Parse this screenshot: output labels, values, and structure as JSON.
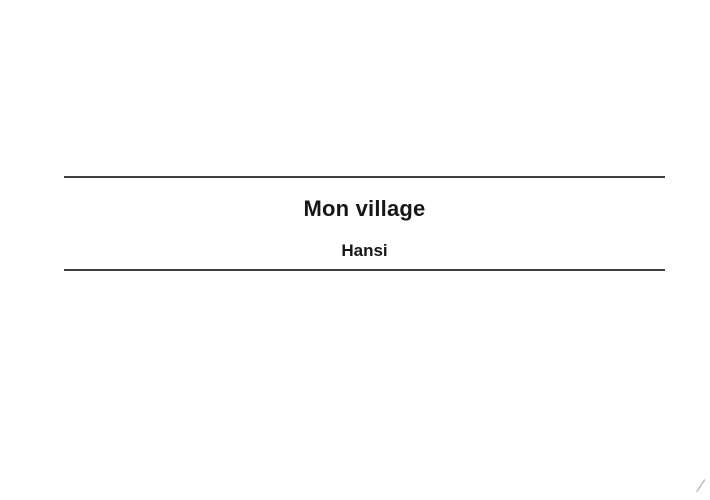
{
  "slide": {
    "title": "Mon village",
    "subtitle": "Hansi",
    "background_color": "#ffffff",
    "text_color": "#171717",
    "rule_color": "#3f3f3f"
  },
  "corner_mark": {
    "icon": "resize-grip-diagonal",
    "color": "#b7bac0"
  }
}
